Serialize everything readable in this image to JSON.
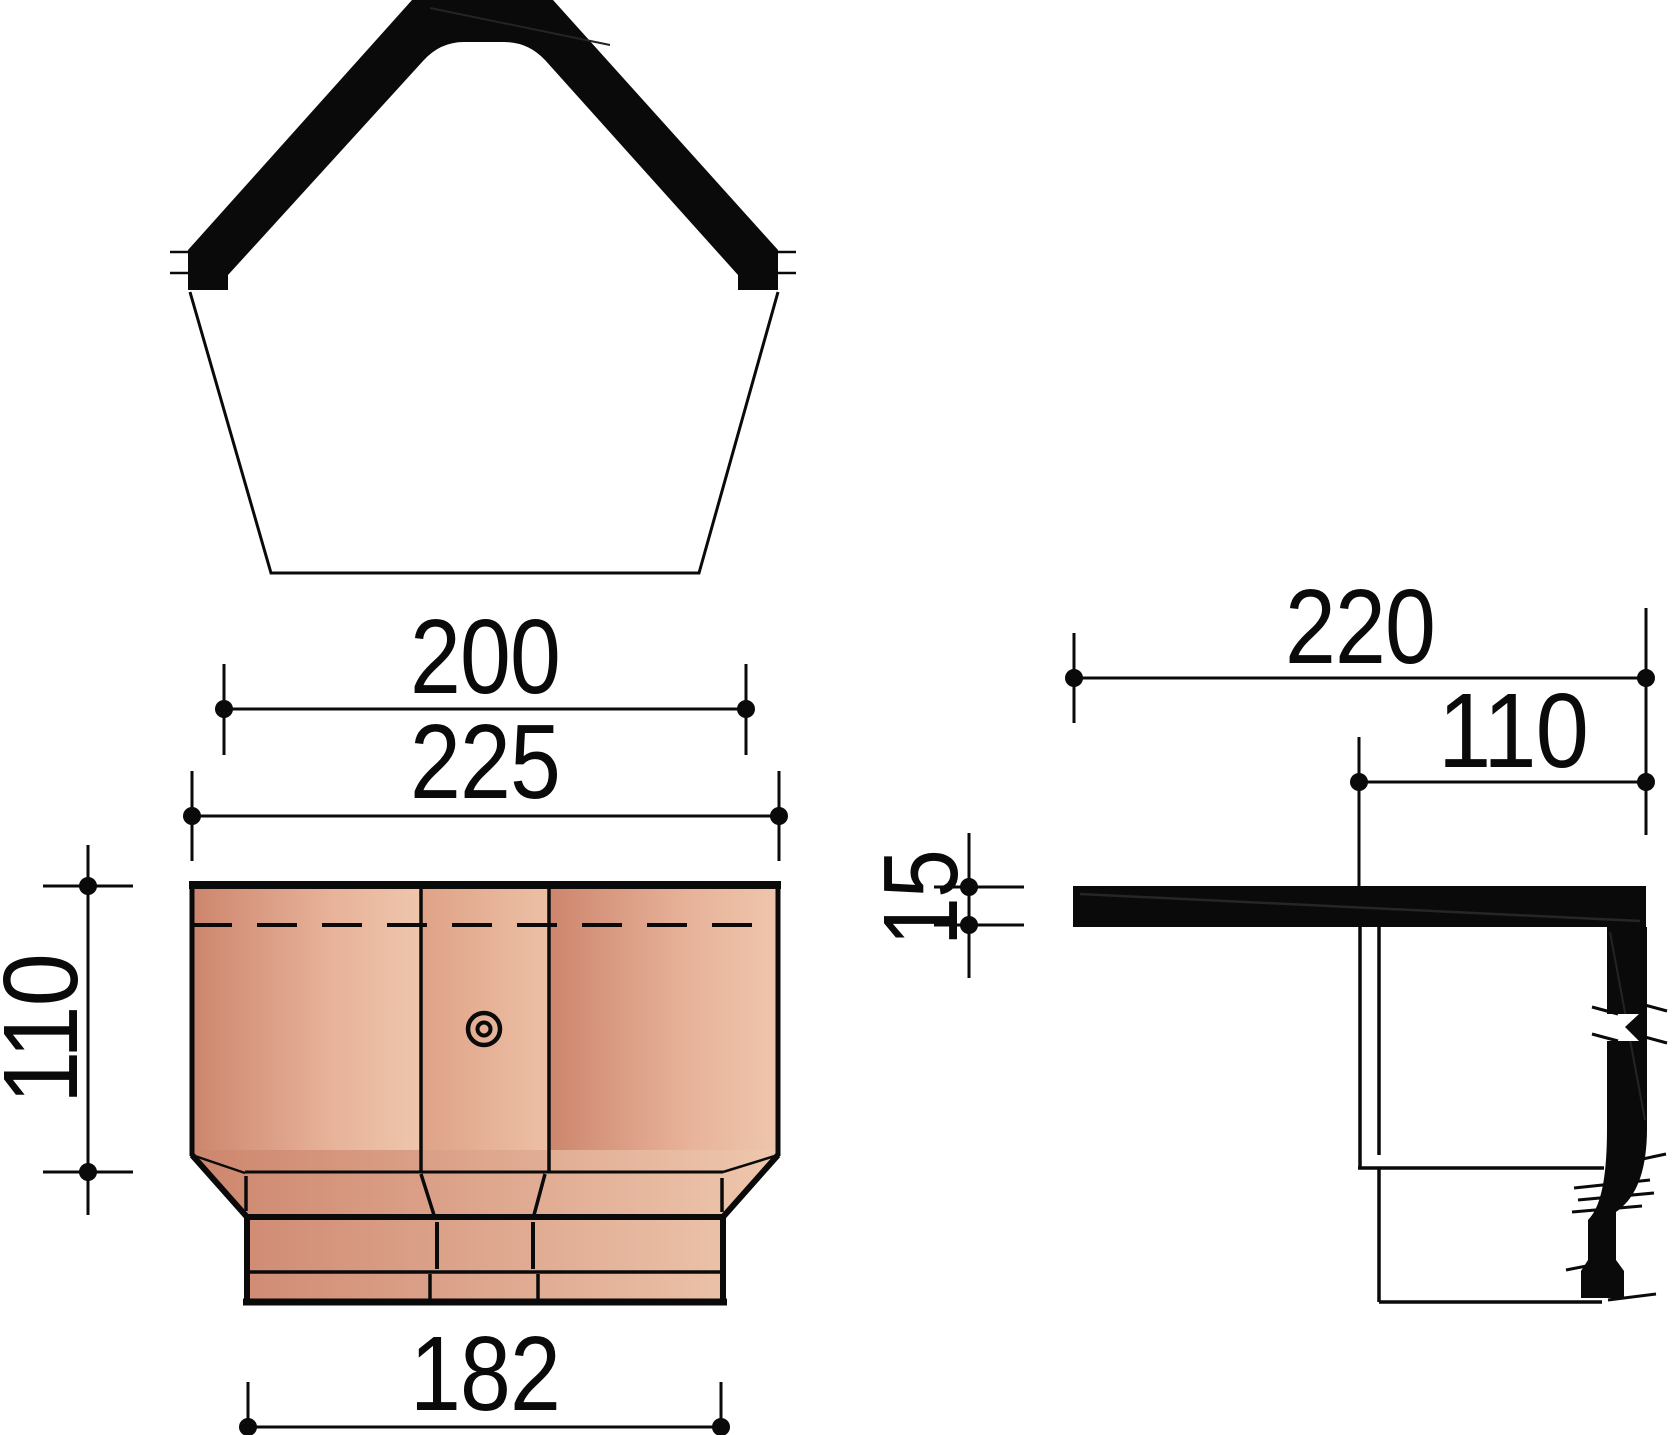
{
  "drawing": {
    "type": "technical-dimension-drawing",
    "background": "#ffffff",
    "ink": "#0a0a0a",
    "tile_colors": {
      "dark": "#cd856d",
      "mid": "#e7b299",
      "light": "#eec6ac",
      "panel2_dark": "#dfa287",
      "panel2_light": "#ecc0a5",
      "band_dark": "#cd856d",
      "band_light": "#eec8ae"
    },
    "front_view": {
      "dimensions": {
        "top_width": "200",
        "overall_width": "225",
        "height": "110",
        "bottom_width": "182"
      }
    },
    "side_view": {
      "dimensions": {
        "overall_depth": "220",
        "inner_depth": "110",
        "thickness": "15"
      }
    }
  }
}
